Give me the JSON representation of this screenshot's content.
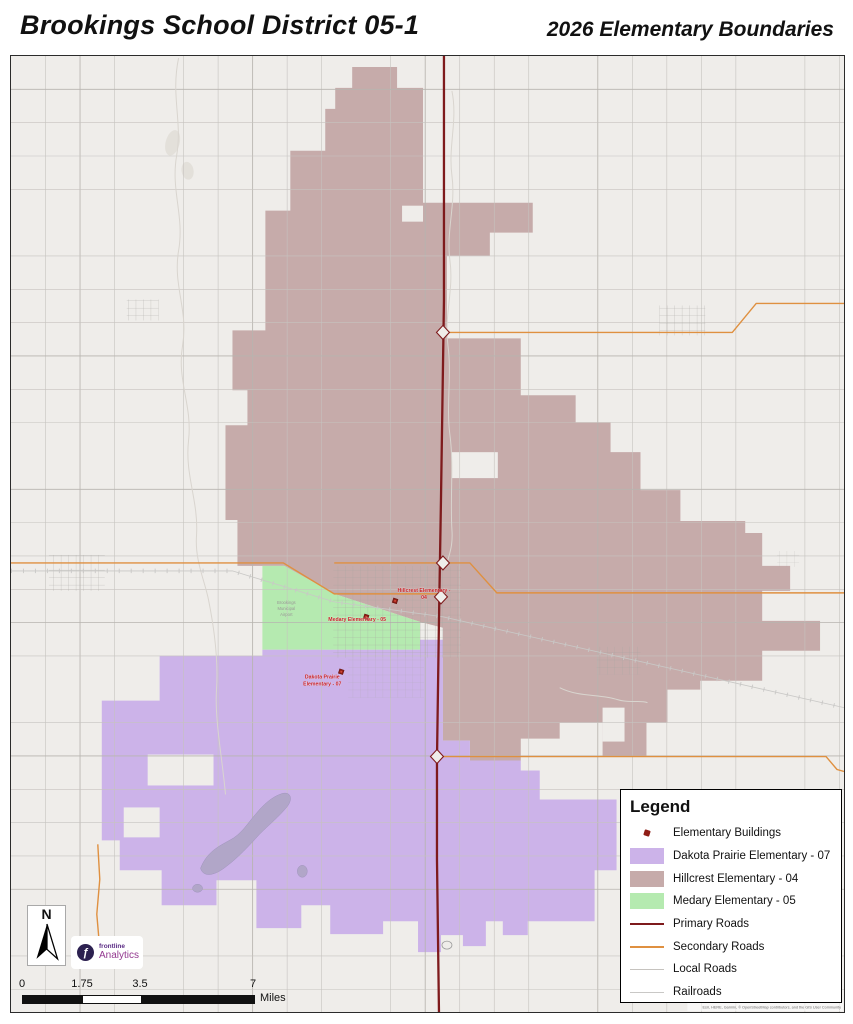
{
  "header": {
    "title_left": "Brookings School District 05-1",
    "title_right": "2026 Elementary Boundaries"
  },
  "legend": {
    "title": "Legend",
    "items": [
      {
        "label": "Elementary Buildings"
      },
      {
        "label": "Dakota Prairie Elementary - 07"
      },
      {
        "label": "Hillcrest Elementary - 04"
      },
      {
        "label": "Medary Elementary - 05"
      },
      {
        "label": "Primary Roads"
      },
      {
        "label": "Secondary Roads"
      },
      {
        "label": "Local Roads"
      },
      {
        "label": "Railroads"
      }
    ]
  },
  "map_labels": {
    "hillcrest_line1": "Hillcrest Elementary -",
    "hillcrest_line2": "04",
    "medary": "Medary Elementary - 05",
    "dakota_line1": "Dakota Prairie",
    "dakota_line2": "Elementary - 07",
    "airport_line1": "Brookings",
    "airport_line2": "Municipal",
    "airport_line3": "Airport",
    "attribution": "Esri, HERE, Garmin, © OpenStreetMap contributors, and the GIS User Community"
  },
  "north_arrow": {
    "label": "N"
  },
  "scale_bar": {
    "ticks": [
      "0",
      "1.75",
      "3.5",
      "7"
    ],
    "unit": "Miles"
  },
  "logo": {
    "brand": "frontline",
    "product": "Analytics"
  },
  "colors": {
    "map_bg": "#efedea",
    "hillcrest": "#c6abaa",
    "dakota_prairie": "#ccb3e9",
    "medary": "#b5eab0",
    "primary_road": "#7e1a1c",
    "secondary_road": "#df9040",
    "local_road": "#c6c3bf",
    "grid_major": "#b7b4af",
    "railroad": "#c9c8c6",
    "water": "#b1a6c8",
    "water_light": "#e3e0da",
    "stream": "#d9d5cf",
    "town": "#a5a3a0",
    "building_marker": "#8f1d15",
    "building_marker_inner": "#d0493a",
    "label_red": "#c81e25",
    "label_gray": "#9a9896",
    "attribution_gray": "#6b6b6b",
    "logo_dark": "#2c2150",
    "logo_purple": "#5b2c85",
    "logo_magenta": "#93388f"
  }
}
